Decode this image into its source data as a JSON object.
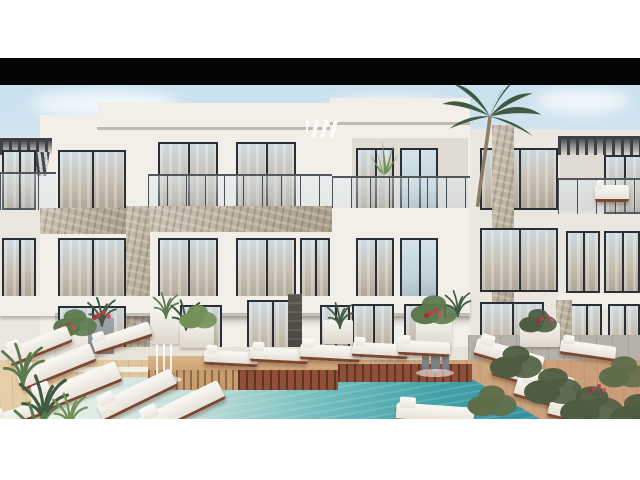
{
  "scene": {
    "type": "architectural_exterior_render",
    "subject": "Modern white three-storey apartment complex with rooftop pergolas, glass balcony railings, stone-clad piers, palm tree, tropical planting, turquoise swimming pool, timber slat sun decks and rows of white sun loungers",
    "time_of_day": "day",
    "sky": "pale blue with soft white clouds",
    "building": {
      "storeys": 3,
      "style": "contemporary minimal",
      "materials": [
        "white plaster",
        "natural beige stone cladding",
        "dark aluminium window frames",
        "frameless glass balustrades",
        "dark timber pergolas"
      ],
      "features": [
        "recessed balconies",
        "central glass entrance doors",
        "white awning fins",
        "balcony agave plant",
        "white balcony sofa"
      ]
    },
    "pool_area": {
      "water_near_side": "pale aqua (shallow shelf with loungers)",
      "water_far_side": "deep turquoise",
      "features": [
        "timber slatted island platform (light and red-brown wood)",
        "statue water-jet fountain",
        "white stream fountain",
        "white pool coping"
      ],
      "sun_loungers": 18,
      "deck": "light tan timber planks with grey stone paving near the building",
      "planting": [
        "palm tufts",
        "banana plants",
        "olive shrubs",
        "red flowering planters"
      ]
    },
    "frame": {
      "top_margin": "white",
      "letterbox_bar": "black",
      "bottom_margin": "white"
    }
  },
  "palette": {
    "page_bg": "#ffffff",
    "black_bar": "#050505",
    "sky_top": "#c9e0ee",
    "sky_bottom": "#eef4f6",
    "cloud": "#ffffff",
    "wall_light": "#f2efe9",
    "wall_mid": "#eae7e1",
    "wall_shade": "#dfdbd3",
    "fascia_shadow": "#bfb9b0",
    "frame_dark": "#2b2e32",
    "glass_curtain": "#c7bfb2",
    "glass_sky": "#cfdbe2",
    "stone_light": "#cdc3b2",
    "stone_dark": "#a99d8a",
    "pier_dark": "#595550",
    "pergola": "#3e4247",
    "pool_pale": "#dcebe5",
    "pool_mid": "#6fbcbd",
    "pool_deep": "#2f8f9b",
    "coping": "#f4f1ea",
    "deck_light": "#e6cfa8",
    "deck_warm": "#c99d79",
    "paving": "#b6b2aa",
    "slat_light": "#c99d6e",
    "slat_red": "#8f4f38",
    "cushion": "#f7f5f0",
    "wood_leg": "#7d4732",
    "foliage_dark": "#3f5a40",
    "foliage_mid": "#5c7a4d",
    "foliage_light": "#739058",
    "olive": "#4e5c41",
    "flower_red": "#b24148",
    "trunk": "#8d7d66",
    "statue_gray": "#9aa0a4"
  }
}
